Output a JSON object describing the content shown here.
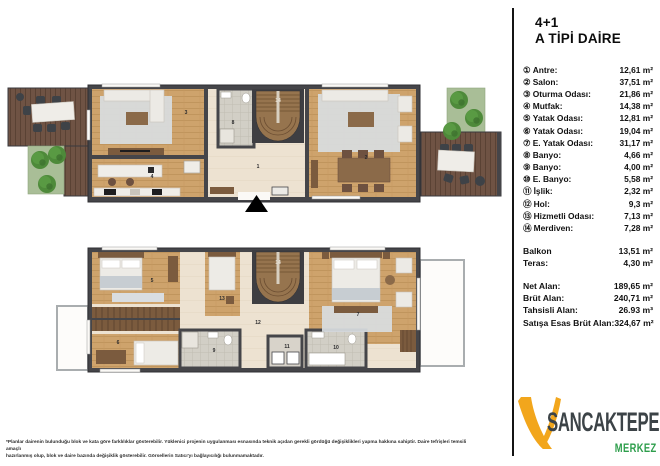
{
  "title": {
    "line1": "4+1",
    "line2": "A TİPİ DAİRE"
  },
  "legend": {
    "items": [
      {
        "num": "①",
        "label": "Antre:",
        "value": "12,61 m²"
      },
      {
        "num": "②",
        "label": "Salon:",
        "value": "37,51 m²"
      },
      {
        "num": "③",
        "label": "Oturma Odası:",
        "value": "21,86 m²"
      },
      {
        "num": "④",
        "label": "Mutfak:",
        "value": "14,38 m²"
      },
      {
        "num": "⑤",
        "label": "Yatak Odası:",
        "value": "12,81 m²"
      },
      {
        "num": "⑥",
        "label": "Yatak Odası:",
        "value": "19,04 m²"
      },
      {
        "num": "⑦",
        "label": "E. Yatak Odası:",
        "value": "31,17 m²"
      },
      {
        "num": "⑧",
        "label": "Banyo:",
        "value": "4,66 m²"
      },
      {
        "num": "⑨",
        "label": "Banyo:",
        "value": "4,00 m²"
      },
      {
        "num": "⑩",
        "label": "E. Banyo:",
        "value": "5,58 m²"
      },
      {
        "num": "⑪",
        "label": "İşlik:",
        "value": "2,32 m²"
      },
      {
        "num": "⑫",
        "label": "Hol:",
        "value": "9,3 m²"
      },
      {
        "num": "⑬",
        "label": "Hizmetli Odası:",
        "value": "7,13 m²"
      },
      {
        "num": "⑭",
        "label": "Merdiven:",
        "value": "7,28 m²"
      }
    ]
  },
  "extras": {
    "balkon_label": "Balkon",
    "balkon_value": "13,51 m²",
    "teras_label": "Teras:",
    "teras_value": "4,30 m²"
  },
  "totals": {
    "net_label": "Net Alan:",
    "net_value": "189,65 m²",
    "brut_label": "Brüt Alan:",
    "brut_value": "240,71 m²",
    "tahsisli_label": "Tahsisli Alan:",
    "tahsisli_value": "26.93 m³",
    "satis_label": "Satışa Esas Brüt Alan:",
    "satis_value": "324,67  m²"
  },
  "logo": {
    "name": "SANCAKTEPE",
    "sub": "MERKEZ",
    "colors": {
      "mark": "#F2A61C",
      "name": "#3C4347",
      "sub": "#2E9E4C"
    }
  },
  "footnote": {
    "line1": "*Planlar dairenin bulunduğu blok ve kata göre farklılıklar gösterebilir. Yüklenici projenin uygulanması esnasında teknik açıdan gerekli gördüğü değişiklikleri yapma hakkına sahiptir. Daire tefrişleri temsili amaçlı",
    "line2": "hazırlanmış olup, blok ve daire bazında değişiklik gösterebilir. Görsellerin Satıcı'yı bağlayıcılığı bulunmamaktadır."
  },
  "plan_labels": {
    "n1": "1",
    "n2": "2",
    "n3": "3",
    "n4": "4",
    "n5": "5",
    "n6": "6",
    "n7": "7",
    "n8": "8",
    "n9": "9",
    "n10": "10",
    "n11": "11",
    "n12": "12",
    "n13": "13",
    "n14": "14"
  },
  "colors": {
    "wall": "#454549",
    "wood_floor": "#CEA36C",
    "deck": "#6F5344",
    "garden": "#A9BE97",
    "tree": "#4E8A3A",
    "hall_floor": "#EDE2D1",
    "tile_floor": "#D2CFC6",
    "rug": "#D9DDE1"
  }
}
